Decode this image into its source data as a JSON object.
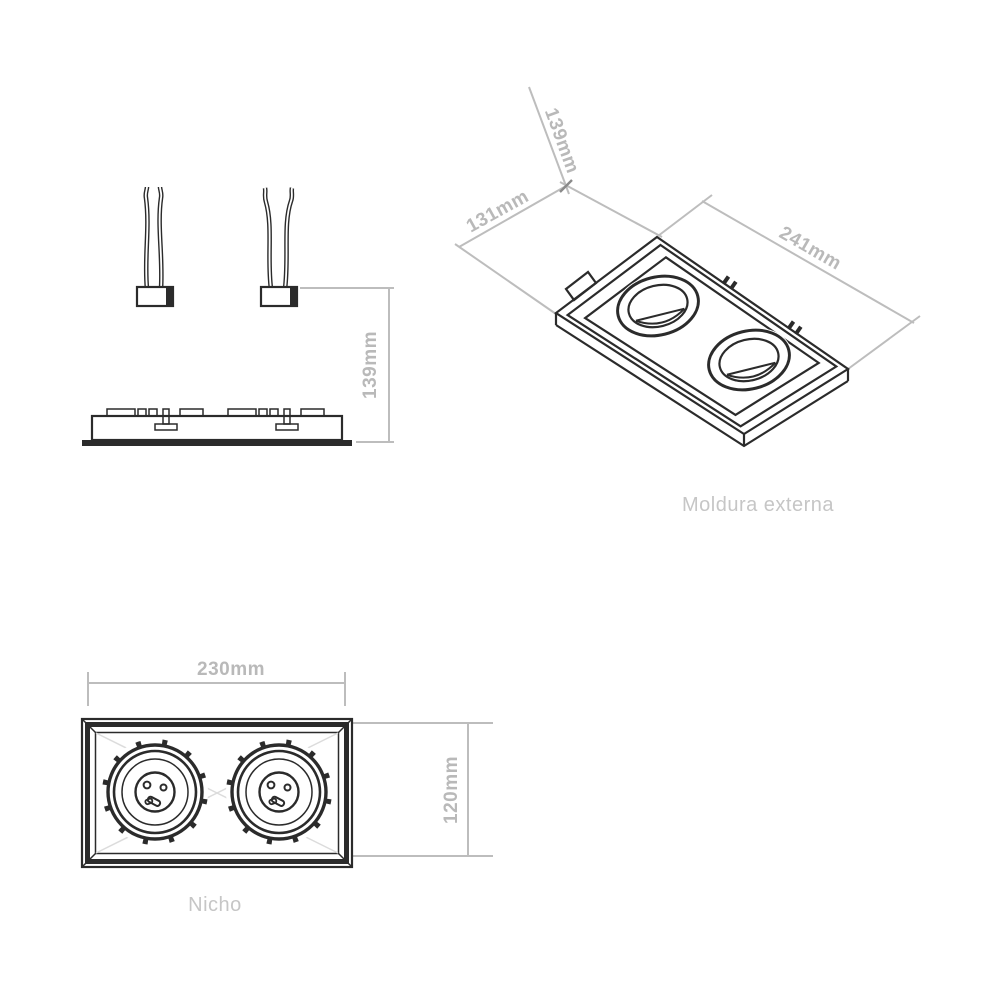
{
  "document": {
    "type": "technical-drawing",
    "background": "#ffffff"
  },
  "colors": {
    "line_art": "#2b2b2b",
    "dimension_lines": "#bdbdbd",
    "dimension_text": "#b9b9b9",
    "caption_text": "#c6c6c6"
  },
  "side_view": {
    "dim_height_label": "139mm"
  },
  "iso_view": {
    "caption": "Moldura externa",
    "dim_depth_label": "139mm",
    "dim_width_label": "131mm",
    "dim_length_label": "241mm"
  },
  "plan_view": {
    "caption": "Nicho",
    "dim_width_label": "230mm",
    "dim_height_label": "120mm"
  }
}
